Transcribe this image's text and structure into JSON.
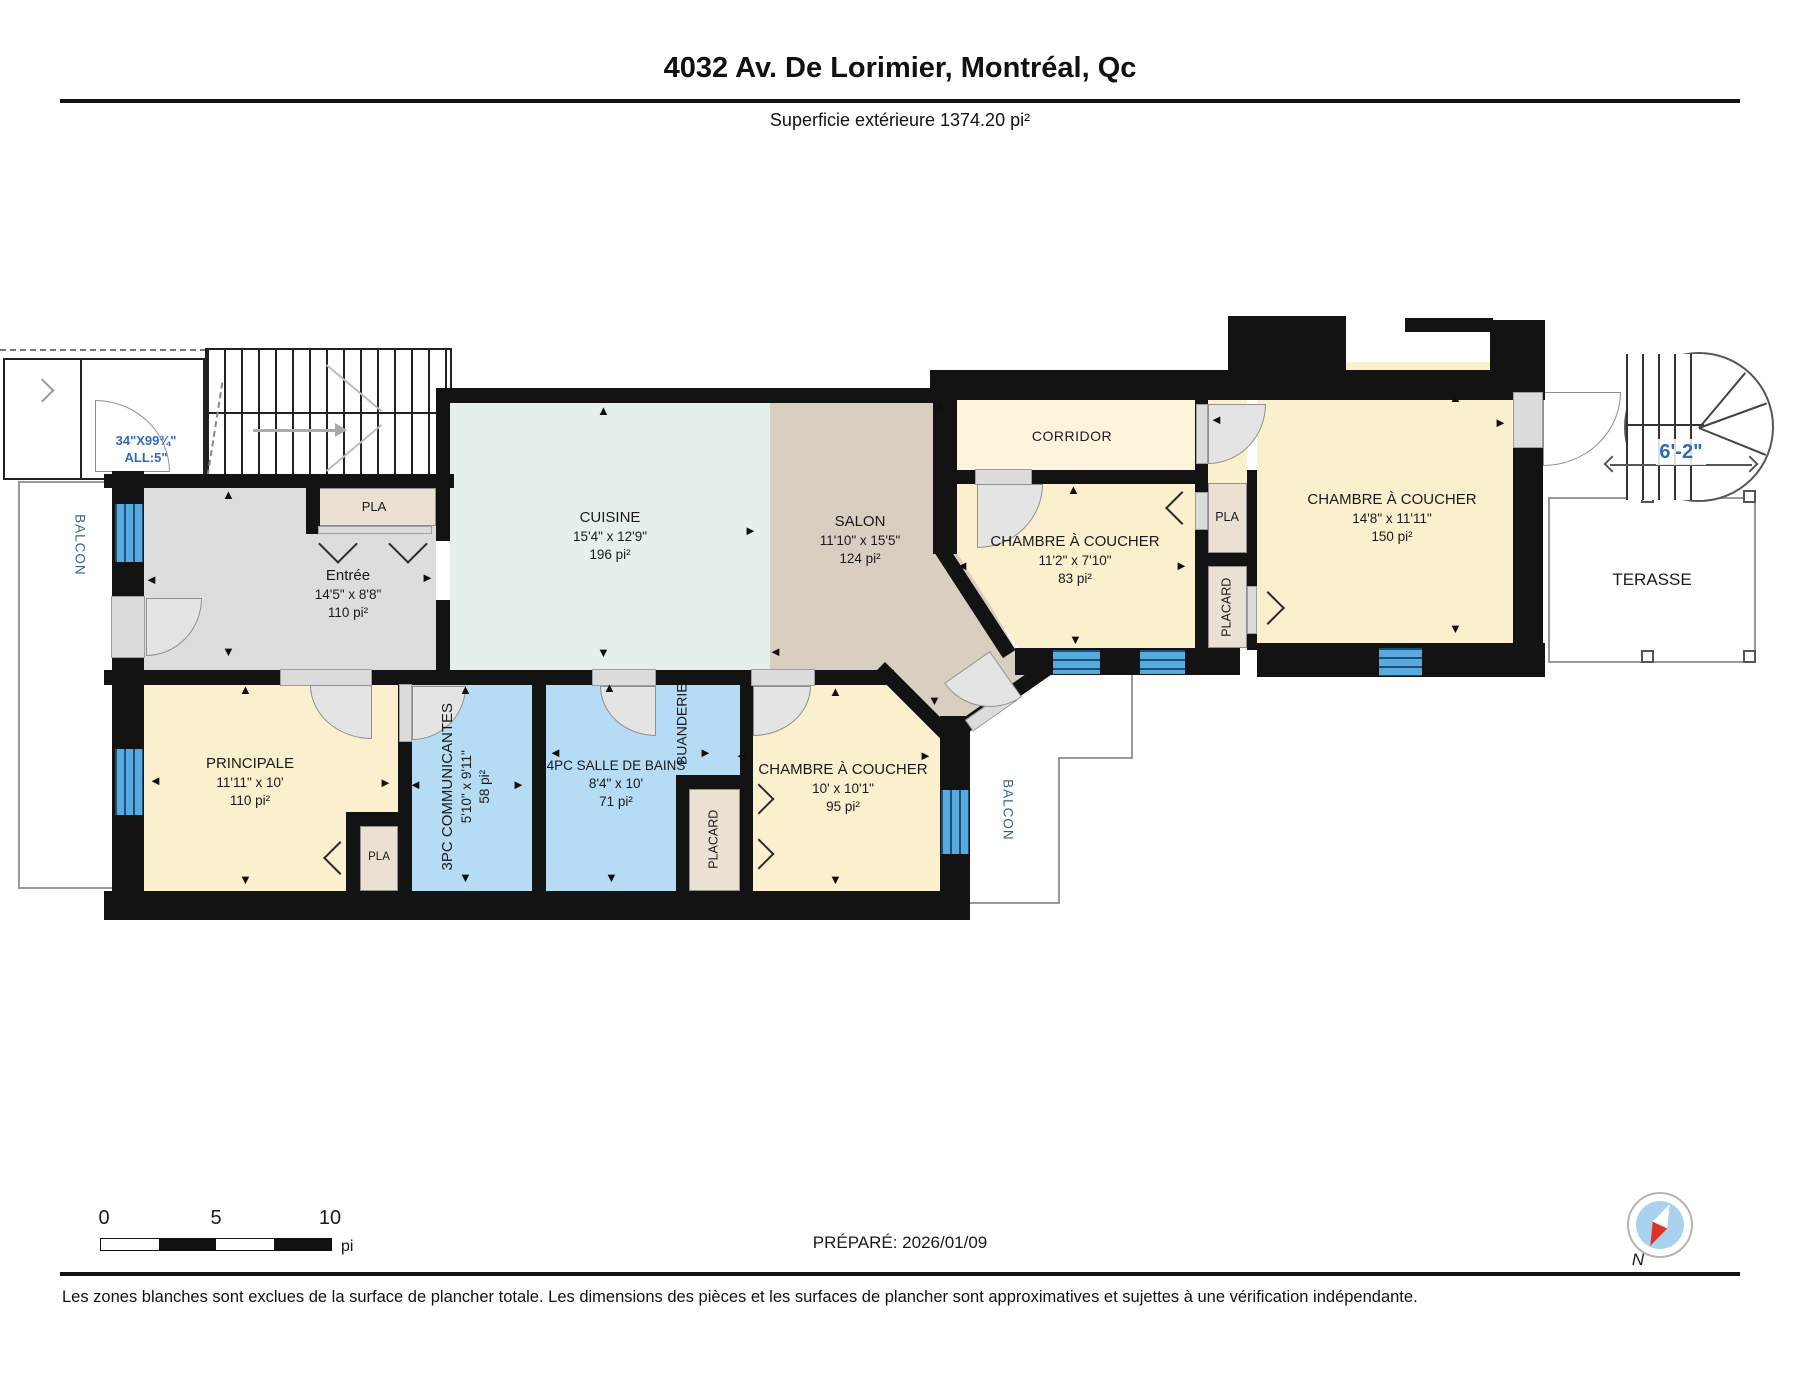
{
  "header": {
    "title": "4032 Av. De Lorimier, Montréal, Qc",
    "subtitle": "Superficie extérieure 1374.20 pi²"
  },
  "rooms": {
    "entree": {
      "name": "Entrée",
      "dims": "14'5\" x 8'8\"",
      "area": "110 pi²"
    },
    "cuisine": {
      "name": "CUISINE",
      "dims": "15'4\" x 12'9\"",
      "area": "196 pi²"
    },
    "salon": {
      "name": "SALON",
      "dims": "11'10\" x 15'5\"",
      "area": "124 pi²"
    },
    "corridor": {
      "name": "CORRIDOR"
    },
    "chambre_nord": {
      "name": "CHAMBRE À COUCHER",
      "dims": "11'2\" x 7'10\"",
      "area": "83 pi²"
    },
    "chambre_est": {
      "name": "CHAMBRE À COUCHER",
      "dims": "14'8\" x 11'11\"",
      "area": "150 pi²"
    },
    "principale": {
      "name": "PRINCIPALE",
      "dims": "11'11\" x 10'",
      "area": "110 pi²"
    },
    "bain_3pc": {
      "name": "3PC COMMUNICANTES",
      "dims": "5'10\" x 9'11\"",
      "area": "58 pi²"
    },
    "bain_4pc": {
      "name": "4PC SALLE DE BAINS",
      "dims": "8'4\" x 10'",
      "area": "71 pi²"
    },
    "chambre_sud": {
      "name": "CHAMBRE À COUCHER",
      "dims": "10' x 10'1\"",
      "area": "95 pi²"
    },
    "buanderie": {
      "name": "BUANDERIE"
    }
  },
  "closets": {
    "pla": "PLA",
    "placard": "PLACARD"
  },
  "exterior": {
    "balcon": "BALCON",
    "terasse": "TERASSE"
  },
  "annotations": {
    "entry_door_size": "34\"X99¾\"",
    "entry_door_allege": "ALL:5\"",
    "escalier_width": "6'-2\""
  },
  "scale_bar": {
    "t0": "0",
    "t5": "5",
    "t10": "10",
    "unit": "pi"
  },
  "footer": {
    "prepared": "PRÉPARÉ: 2026/01/09",
    "disclaimer": "Les zones blanches sont exclues de la surface de plancher totale. Les dimensions des pièces et les surfaces de plancher sont approximatives et sujettes à une vérification indépendante."
  },
  "compass": {
    "north": "N"
  },
  "icons": {
    "arrow_up": "▲",
    "arrow_down": "▼",
    "arrow_left": "◄",
    "arrow_right": "►"
  }
}
